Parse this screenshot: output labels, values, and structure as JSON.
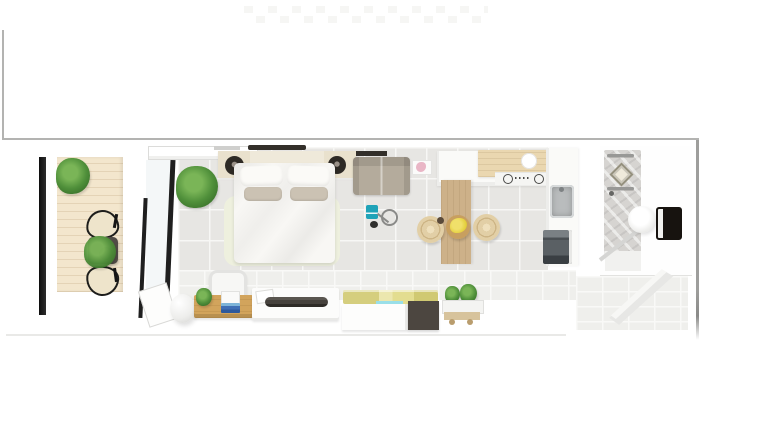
{
  "scene": {
    "type": "floor-plan-3d-top-view",
    "description": "Top-down 3D architectural render of a long narrow studio apartment with balcony, bedroom-living area, kitchen and bathroom, on a white background with a thin gray partial frame",
    "rooms": [
      {
        "name": "balcony",
        "floor": "wood-plank-deck",
        "items": [
          "potted-plant",
          "potted-plant",
          "bistro-table",
          "table-plant",
          "wire-chair",
          "wire-chair",
          "dark-pillar",
          "glass-sliding-door"
        ]
      },
      {
        "name": "bedroom-living",
        "floor": "gray-ceramic-tiles",
        "items": [
          "double-bed",
          "headboard-console",
          "nightstand-speaker",
          "nightstand-speaker",
          "pillows",
          "area-rug",
          "potted-plant",
          "loveseat-sofa",
          "wall-shelf",
          "teal-book",
          "floor-reading-lamp",
          "egg-floor-lamp",
          "wood-desk",
          "desk-chair",
          "desk-plant",
          "blue-books",
          "media-console",
          "soundbar",
          "storage-daybed",
          "cushions",
          "plant-trolley"
        ]
      },
      {
        "name": "kitchen",
        "floor": "gray-ceramic-tiles",
        "items": [
          "base-cabinets",
          "wood-worktop",
          "cooktop",
          "kitchen-island",
          "bar-stool",
          "bar-stool",
          "fruit-bowl-bananas",
          "stainless-sink",
          "oven-appliance",
          "side-table"
        ]
      },
      {
        "name": "bathroom",
        "floor": "white-screed",
        "items": [
          "walk-in-shower",
          "marble-shower-wall",
          "shower-head",
          "towel-bar",
          "vessel-sink",
          "mirror-cabinet",
          "glass-shower-screen"
        ]
      }
    ]
  },
  "palette": {
    "bg": "#ffffff",
    "frame_line": "#b3b3b1",
    "tile_floor": "#e7e6e3",
    "tile_grout": "#f7f7f5",
    "wall_tile": "#efefec",
    "deck_wood": "#f3e6cd",
    "deck_line": "#e4d3b6",
    "black_frame": "#1f1f1f",
    "plant_green": "#4f8f3a",
    "plant_dark": "#2f6323",
    "table_dark": "#514c46",
    "chair_seat": "#eee4cb",
    "headboard": "#efe9da",
    "nightstand": "#e9e1cd",
    "speaker": "#2e2a25",
    "bed_white": "#f8f7f4",
    "pillow_taupe": "#cbc2b3",
    "rug": "#eef0de",
    "sofa": "#b4ab9c",
    "shelf_dark": "#332f2a",
    "teal": "#1fa3b8",
    "wood_desk": "#d2a45c",
    "books_blue": "#3f6fb5",
    "soundbar": "#46423d",
    "cushion_yellow": "#d5ce7e",
    "cushion_pale": "#ece7af",
    "accent_cyan": "#9adfe8",
    "charcoal": "#4c4640",
    "trolley_wood": "#d7c39c",
    "counter_white": "#fafaf8",
    "counter_wood": "#ead7b0",
    "island_wood": "#cdb189",
    "stool_rattan": "#e2cfa6",
    "banana": "#e4cf3b",
    "steel": "#b9bcbd",
    "appliance": "#54595d",
    "marble": "#d6d4d1",
    "chrome": "#989896",
    "mirror_black": "#17130f",
    "pink": "#e9b6c6"
  }
}
